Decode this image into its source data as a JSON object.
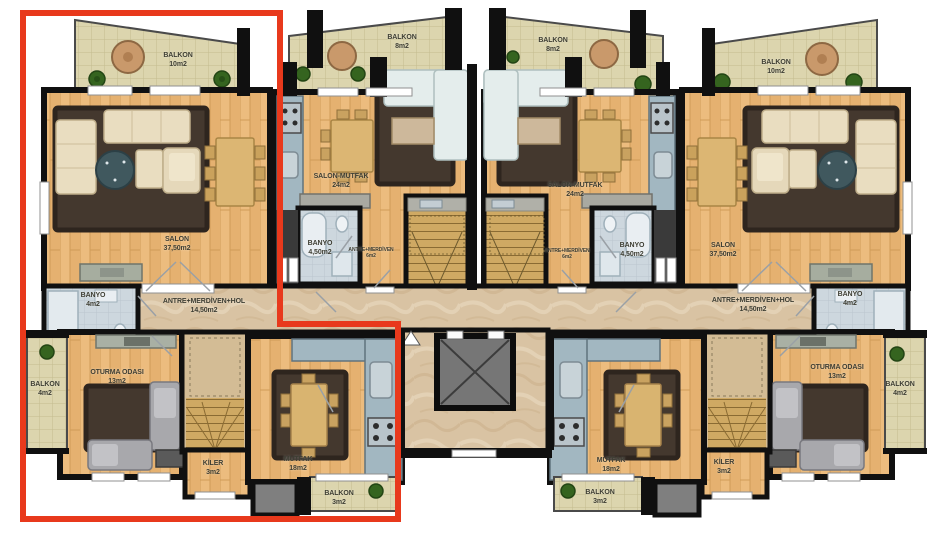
{
  "colors": {
    "highlight_outline": "#e8391c",
    "wall": "#101010",
    "wood_floor": "#ecbc7e",
    "balcony_tile": "#dcd5ae",
    "corridor_marble": "#d9c3a3",
    "bathroom_floor": "#cdd7de",
    "kitchen_counter": "#a2b7c1",
    "rug": "#44382e"
  },
  "apartments": {
    "left": {
      "balkon_top": {
        "name": "BALKON",
        "area": "10m2"
      },
      "salon": {
        "name": "SALON",
        "area": "37,50m2"
      },
      "banyo": {
        "name": "BANYO",
        "area": "4m2"
      },
      "hall": {
        "name": "ANTRE+MERDİVEN+HOL",
        "area": "14,50m2"
      },
      "oturma": {
        "name": "OTURMA ODASI",
        "area": "13m2"
      },
      "balkon_side": {
        "name": "BALKON",
        "area": "4m2"
      },
      "kiler": {
        "name": "KİLER",
        "area": "3m2"
      },
      "mutfak": {
        "name": "MUTFAK",
        "area": "18m2"
      },
      "balkon_bottom": {
        "name": "BALKON",
        "area": "3m2"
      }
    },
    "mid_left": {
      "balkon": {
        "name": "BALKON",
        "area": "8m2"
      },
      "salon_mutfak": {
        "name": "SALON-MUTFAK",
        "area": "24m2"
      },
      "banyo": {
        "name": "BANYO",
        "area": "4,50m2"
      },
      "antre": {
        "name": "ANTRE+MERDİVEN",
        "area": "6m2"
      }
    },
    "mid_right": {
      "balkon": {
        "name": "BALKON",
        "area": "8m2"
      },
      "salon_mutfak": {
        "name": "SALON-MUTFAK",
        "area": "24m2"
      },
      "banyo": {
        "name": "BANYO",
        "area": "4,50m2"
      },
      "antre": {
        "name": "ANTRE+MERDİVEN",
        "area": "6m2"
      }
    },
    "right": {
      "balkon_top": {
        "name": "BALKON",
        "area": "10m2"
      },
      "salon": {
        "name": "SALON",
        "area": "37,50m2"
      },
      "banyo": {
        "name": "BANYO",
        "area": "4m2"
      },
      "hall": {
        "name": "ANTRE+MERDİVEN+HOL",
        "area": "14,50m2"
      },
      "oturma": {
        "name": "OTURMA ODASI",
        "area": "13m2"
      },
      "balkon_side": {
        "name": "BALKON",
        "area": "4m2"
      },
      "kiler": {
        "name": "KİLER",
        "area": "3m2"
      },
      "mutfak": {
        "name": "MUTFAK",
        "area": "18m2"
      },
      "balkon_bottom": {
        "name": "BALKON",
        "area": "3m2"
      }
    }
  }
}
